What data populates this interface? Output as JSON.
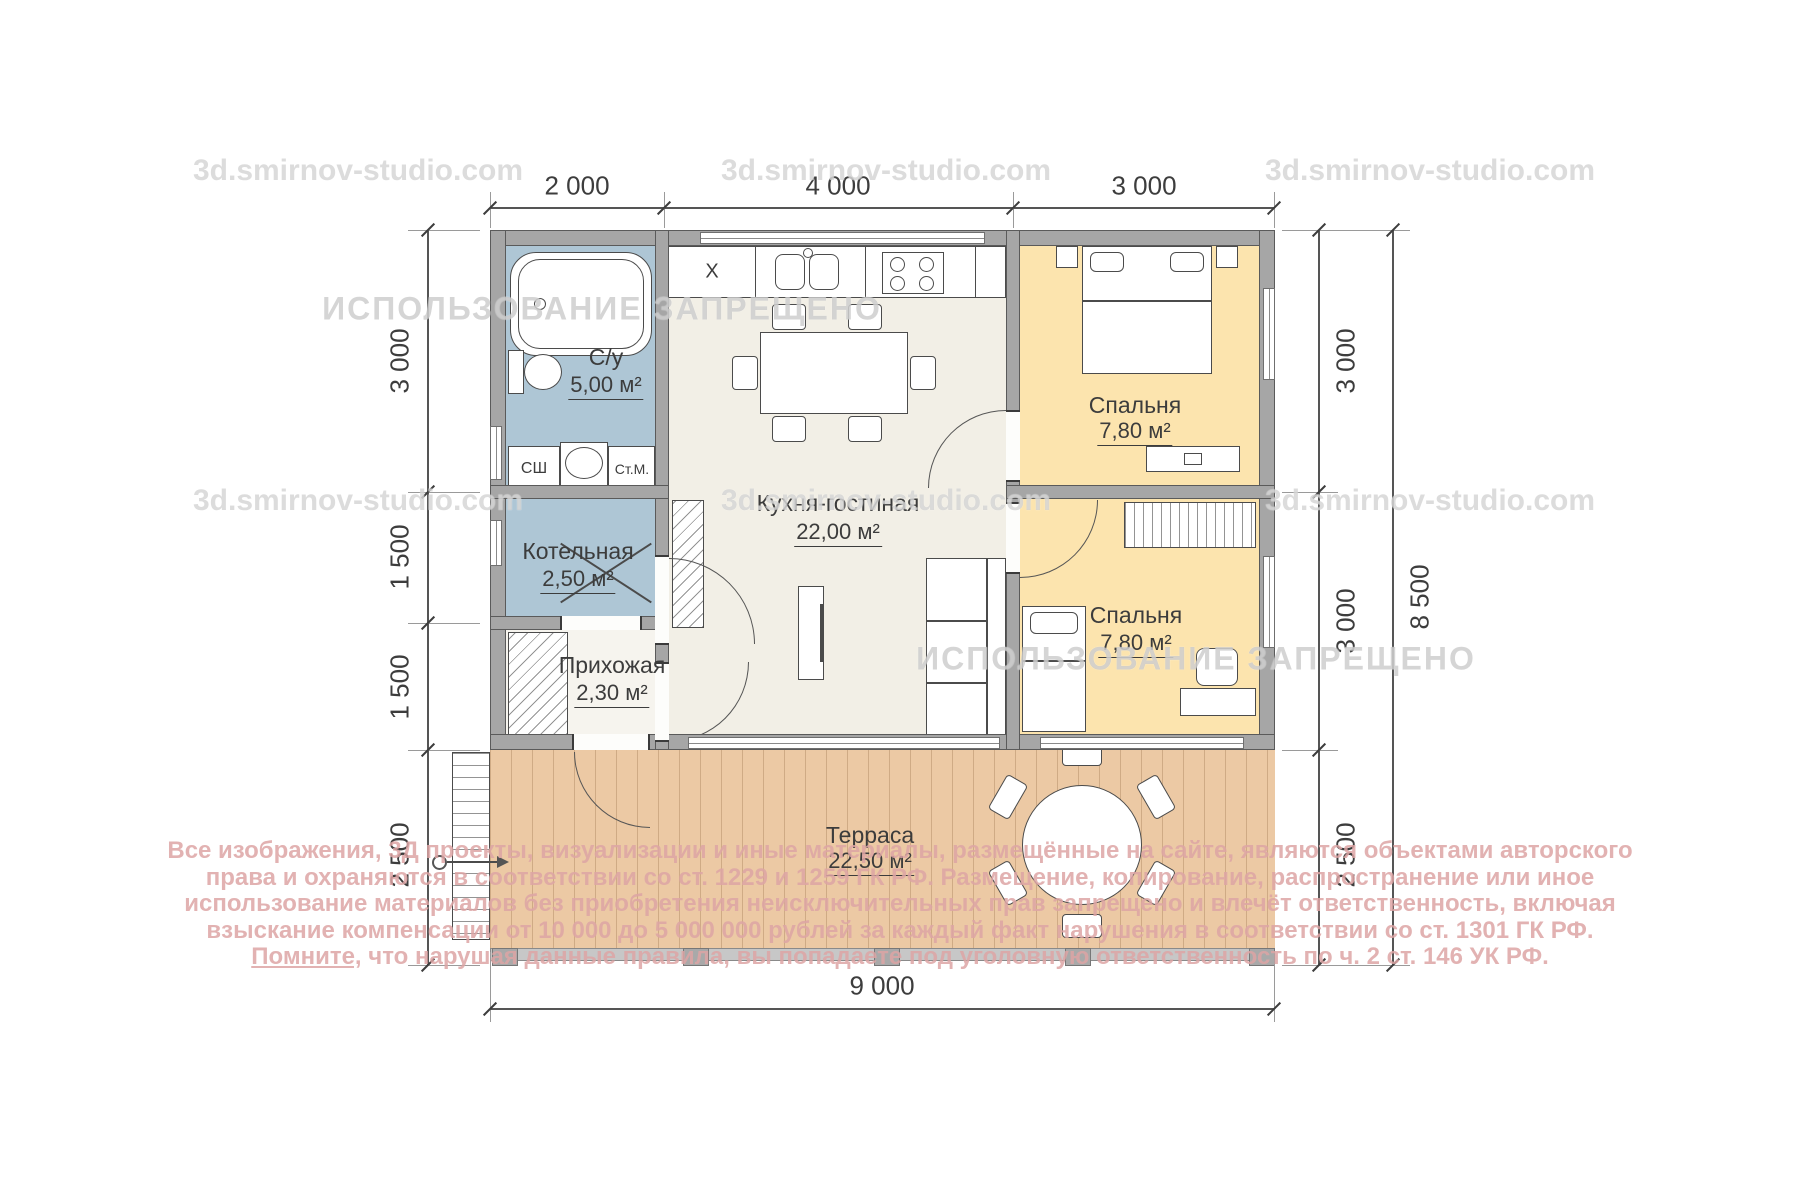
{
  "watermarks": {
    "studio": "3d.smirnov-studio.com",
    "forbidden": "ИСПОЛЬЗОВАНИЕ ЗАПРЕЩЕНО"
  },
  "dimensions": {
    "top": [
      "2 000",
      "4 000",
      "3 000"
    ],
    "left": [
      "3 000",
      "1 500",
      "1 500",
      "2 500"
    ],
    "right": [
      "3 000",
      "3 000",
      "2 500"
    ],
    "right_total": "8 500",
    "bottom": "9 000"
  },
  "rooms": {
    "bathroom": {
      "name": "С/у",
      "area": "5,00 м²"
    },
    "boiler": {
      "name": "Котельная",
      "area": "2,50 м²"
    },
    "hallway": {
      "name": "Прихожая",
      "area": "2,30 м²"
    },
    "kitchen": {
      "name": "Кухня-гостиная",
      "area": "22,00 м²"
    },
    "bedroom1": {
      "name": "Спальня",
      "area": "7,80 м²"
    },
    "bedroom2": {
      "name": "Спальня",
      "area": "7,80 м²"
    },
    "terrace": {
      "name": "Терраса",
      "area": "22,50 м²"
    }
  },
  "appliances": {
    "dryer": "СШ",
    "washer": "Ст.М.",
    "fridge": "Х"
  },
  "legal": {
    "line1": "Все изображения, 3Д проекты, визуализации и иные материалы, размещённые на сайте, являются объектами авторского",
    "line2": "права и охраняются в соответствии со ст. 1229 и 1259 ГК РФ. Размещение, копирование, распространение или иное",
    "line3": "использование материалов без приобретения неисключительных прав запрещено и влечёт ответственность, включая",
    "line4": "взыскание компенсации от 10 000 до 5 000 000 рублей за каждый факт нарушения в соответствии со ст. 1301 ГК РФ.",
    "line5_prefix": "Помните,",
    "line5_rest": " что нарушая данные правила, вы попадаете под уголовную ответственность по ч. 2 ст. 146 УК РФ."
  },
  "colors": {
    "wet_room_fill": "#aec6d5",
    "bedroom_fill": "#fce4ae",
    "living_fill": "#f2efe6",
    "terrace_fill": "#ecc9a4",
    "wall": "#a6a6a6",
    "dimension_text": "#3d3d3d",
    "legal_text": "#dda4a4",
    "watermark": "#b9b9b9"
  }
}
